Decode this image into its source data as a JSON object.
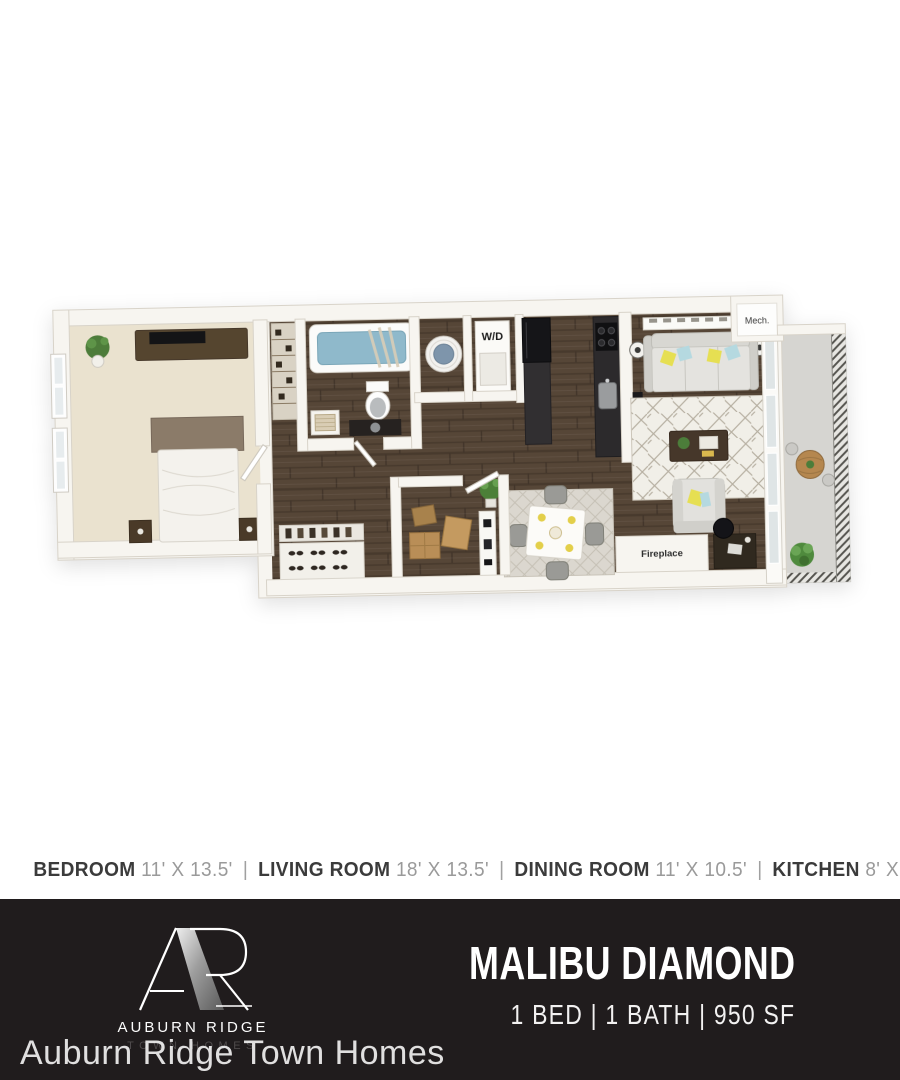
{
  "floor_plan": {
    "labels": {
      "washer_dryer": "W/D",
      "mech": "Mech.",
      "fireplace": "Fireplace"
    }
  },
  "dimensions_bar": {
    "separator": "|",
    "rooms": [
      {
        "name": "BEDROOM",
        "size": "11' X 13.5'"
      },
      {
        "name": "LIVING ROOM",
        "size": "18' X 13.5'"
      },
      {
        "name": "DINING ROOM",
        "size": "11' X 10.5'"
      },
      {
        "name": "KITCHEN",
        "size": "8' X 8'"
      }
    ]
  },
  "footer": {
    "brand": {
      "monogram": "AR",
      "name": "AUBURN RIDGE",
      "tagline": "TOWN HOMES"
    },
    "plan_name": "MALIBU DIAMOND",
    "specs": "1 BED | 1 BATH | 950 SF",
    "bg_color": "#201c1d"
  },
  "watermark": "Auburn Ridge Town Homes",
  "colors": {
    "wall": "#f7f5f0",
    "wood_floor": "#564637",
    "carpet": "#eae2cf",
    "tub_water": "#8fb9cb",
    "pillow_yellow": "#e6df52",
    "pillow_blue": "#b5d9e0",
    "balcony_floor": "#d6d5d1"
  }
}
